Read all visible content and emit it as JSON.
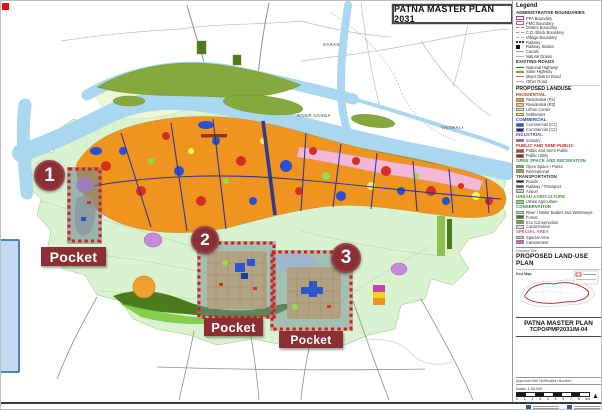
{
  "theme": {
    "pocket_maroon": "#8B2F33",
    "dashed_red": "#E81212",
    "river_blue": "#A9D7EF",
    "residential_orange": "#F09420",
    "ppa_green": "#D9F2CF",
    "special_pink": "#F2B8D8"
  },
  "sheet": {
    "title_box": "PATNA MASTER PLAN 2031"
  },
  "map": {
    "labels": [
      {
        "text": "SARAN",
        "x": 322,
        "y": 41
      },
      {
        "text": "RIVER GANGA",
        "x": 296,
        "y": 112
      },
      {
        "text": "VAISHALI",
        "x": 440,
        "y": 124
      }
    ]
  },
  "pockets": [
    {
      "number": "1",
      "label": "Pocket",
      "circle": {
        "x": 33,
        "y": 159,
        "d": 31
      },
      "label_box": {
        "x": 40,
        "y": 246,
        "w": 65,
        "h": 19
      },
      "rect": {
        "x": 68,
        "y": 168,
        "w": 31,
        "h": 72
      }
    },
    {
      "number": "2",
      "label": "Pocket",
      "circle": {
        "x": 190,
        "y": 225,
        "d": 28
      },
      "label_box": {
        "x": 203,
        "y": 317,
        "w": 59,
        "h": 18
      },
      "rect": {
        "x": 198,
        "y": 242,
        "w": 75,
        "h": 74
      }
    },
    {
      "number": "3",
      "label": "Pocket",
      "circle": {
        "x": 330,
        "y": 242,
        "d": 30
      },
      "label_box": {
        "x": 278,
        "y": 330,
        "w": 64,
        "h": 17
      },
      "rect": {
        "x": 271,
        "y": 251,
        "w": 79,
        "h": 77
      }
    }
  ],
  "legend": {
    "title": "Legend",
    "sections": [
      {
        "header": "ADMINISTRATIVE BOUNDARIES",
        "header_color": "#222222",
        "items": [
          {
            "label": "PPA Boundary",
            "swatch": "outline",
            "color": "#8E4A9E"
          },
          {
            "label": "PMC Boundary",
            "swatch": "outline",
            "color": "#C85A9E"
          },
          {
            "label": "District Boundary",
            "swatch": "dash",
            "color": "#8a7a5a"
          },
          {
            "label": "C.D. Block Boundary",
            "swatch": "dash",
            "color": "#999999"
          },
          {
            "label": "Village Boundary",
            "swatch": "dash",
            "color": "#bbbbbb"
          },
          {
            "label": "Railway",
            "swatch": "rail",
            "color": "#333333"
          },
          {
            "label": "Railway Station",
            "swatch": "square",
            "color": "#111111"
          },
          {
            "label": "Canals",
            "swatch": "line",
            "color": "#66AADD"
          },
          {
            "label": "Natural Drains",
            "swatch": "line",
            "color": "#99BBCC"
          }
        ]
      },
      {
        "header": "EXISTING ROADS",
        "header_color": "#222222",
        "items": [
          {
            "label": "National Highway",
            "swatch": "line",
            "color": "#CC2222"
          },
          {
            "label": "State Highway",
            "swatch": "line",
            "color": "#DD8822"
          },
          {
            "label": "Major District Road",
            "swatch": "line",
            "color": "#777777"
          },
          {
            "label": "Other Road",
            "swatch": "line",
            "color": "#AAAAAA"
          }
        ]
      },
      {
        "header": "PROPOSED LANDUSE",
        "header_color": "#111111",
        "big": true,
        "items": []
      },
      {
        "header": "RESIDENTIAL",
        "header_color": "#B03A1A",
        "items": [
          {
            "label": "Residential (R1)",
            "swatch": "fill",
            "color": "#F09420"
          },
          {
            "label": "Residential (R2)",
            "swatch": "fill",
            "color": "#F7C47E"
          },
          {
            "label": "Urban Center",
            "swatch": "fill",
            "color": "#FAF0A0"
          },
          {
            "label": "Settlement",
            "swatch": "fill",
            "color": "#FCEE4A"
          }
        ]
      },
      {
        "header": "COMMERCIAL",
        "header_color": "#1F3FAE",
        "items": [
          {
            "label": "Commercial (C1)",
            "swatch": "fill",
            "color": "#2F55CC"
          },
          {
            "label": "Commercial (C2)",
            "swatch": "fill",
            "color": "#16248E"
          }
        ]
      },
      {
        "header": "INDUSTRIAL",
        "header_color": "#7A3E9D",
        "items": [
          {
            "label": "Industry",
            "swatch": "fill",
            "color": "#9C55A8"
          }
        ]
      },
      {
        "header": "PUBLIC AND SEMI-PUBLIC",
        "header_color": "#C22222",
        "items": [
          {
            "label": "Public and Semi-Public",
            "swatch": "fill",
            "color": "#E33030"
          },
          {
            "label": "Public Utility",
            "swatch": "fill",
            "color": "#B51A1A"
          }
        ]
      },
      {
        "header": "OPEN SPACE AND RECREATION",
        "header_color": "#2E8B57",
        "items": [
          {
            "label": "Open Space / Parks",
            "swatch": "fill",
            "color": "#6FCB2F"
          },
          {
            "label": "Recreational",
            "swatch": "fill",
            "color": "#93A83A"
          }
        ]
      },
      {
        "header": "TRANSPORTATION",
        "header_color": "#333333",
        "items": [
          {
            "label": "Roads",
            "swatch": "fill",
            "color": "#1A1A1A"
          },
          {
            "label": "Railway / Transport",
            "swatch": "fill",
            "color": "#4D4D4D"
          },
          {
            "label": "Airport",
            "swatch": "hatch",
            "color": "#9E9E9E"
          }
        ]
      },
      {
        "header": "URBAN AGRICULTURE",
        "header_color": "#3F9E2F",
        "items": [
          {
            "label": "Urban Agriculture",
            "swatch": "fill",
            "color": "#8FE04F"
          }
        ]
      },
      {
        "header": "CONSERVATION",
        "header_color": "#2E7D32",
        "items": [
          {
            "label": "River / Water Bodies and Waterways",
            "swatch": "fill",
            "color": "#AEDCF0"
          },
          {
            "label": "Forest",
            "swatch": "fill",
            "color": "#3F7A1F"
          },
          {
            "label": "Eco Conservation",
            "swatch": "fill",
            "color": "#7E9C2A"
          },
          {
            "label": "Conservation",
            "swatch": "fill",
            "color": "#CDE8C2"
          }
        ]
      },
      {
        "header": "SPECIAL AREA",
        "header_color": "#C2559E",
        "items": [
          {
            "label": "Special Area",
            "swatch": "fill",
            "color": "#F2A8C8"
          },
          {
            "label": "Cantonment",
            "swatch": "fill",
            "color": "#E060A8"
          }
        ]
      }
    ],
    "drawing": {
      "label": "Drawing Title",
      "title": "PROPOSED LAND-USE PLAN"
    },
    "keymap": {
      "label": "Key Map"
    },
    "plan": {
      "name": "PATNA MASTER PLAN",
      "number": "TCPO/PMP2031/M-04"
    },
    "scale": {
      "approval_label": "Approval vide Notification Number",
      "scale_label": "Scale: 1:50,000",
      "ticks": [
        "0",
        "1",
        "2",
        "3",
        "4",
        "5",
        "6",
        "7",
        "8"
      ],
      "unit": "km"
    }
  }
}
